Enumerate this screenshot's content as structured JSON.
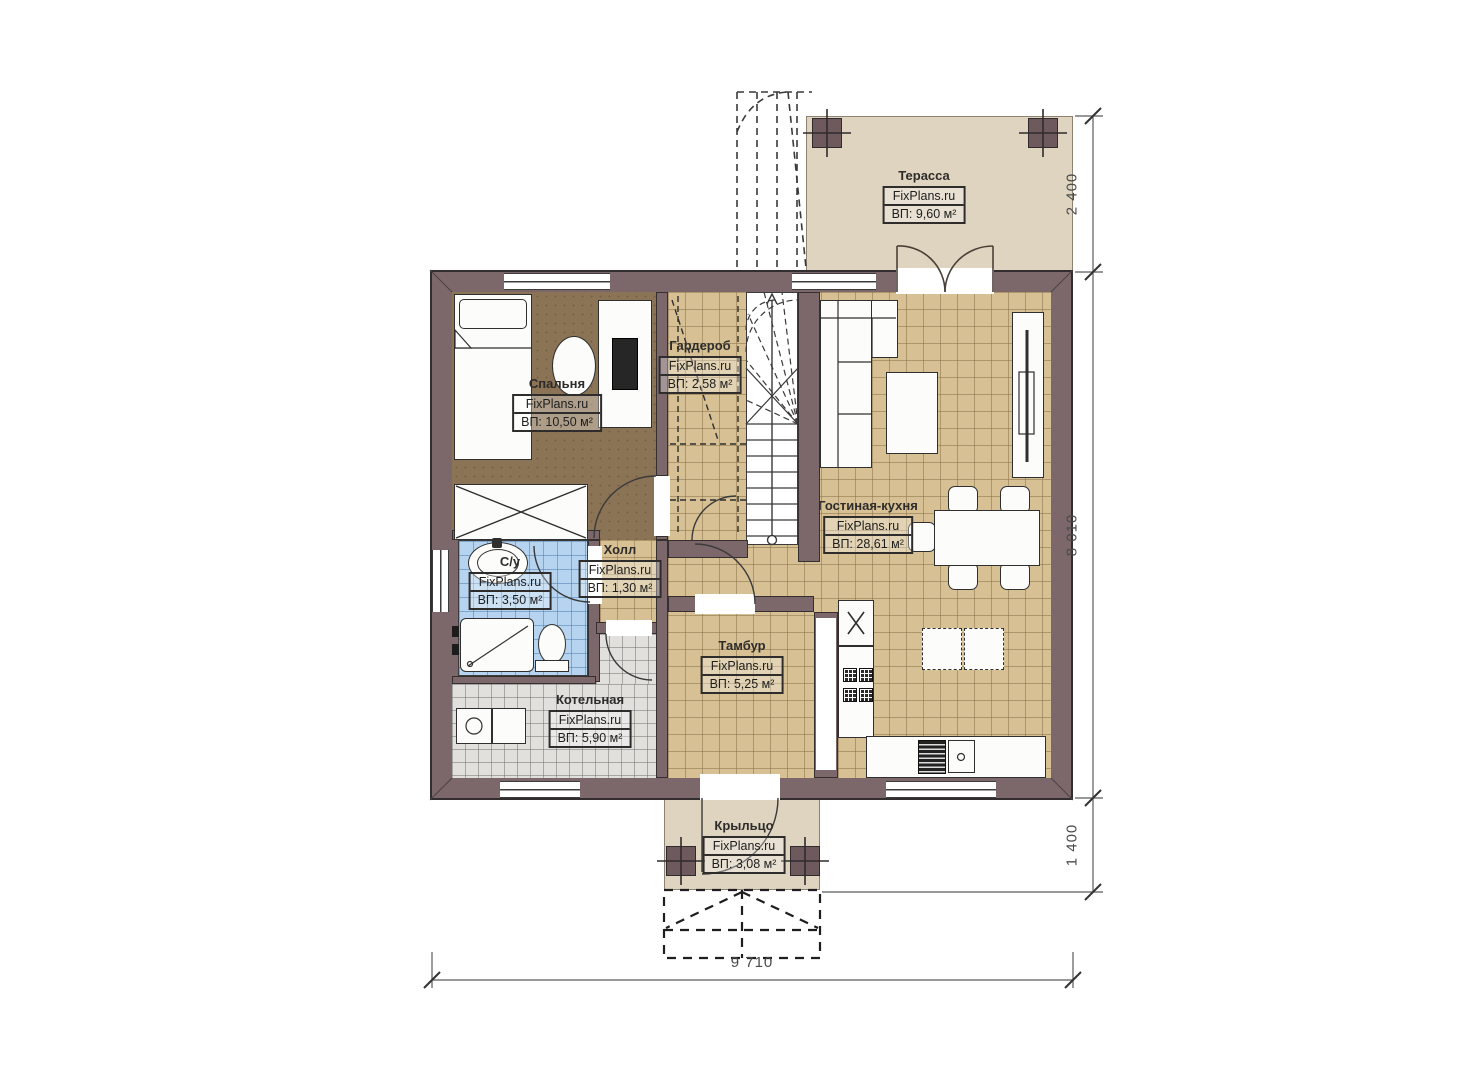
{
  "plan": {
    "brand": "FixPlans.ru",
    "rooms": [
      {
        "id": "terrace",
        "name": "Терасса",
        "brand": "FixPlans.ru",
        "area": "ВП: 9,60 м²"
      },
      {
        "id": "bedroom",
        "name": "Спальня",
        "brand": "FixPlans.ru",
        "area": "ВП: 10,50 м²"
      },
      {
        "id": "wardrobe",
        "name": "Гардероб",
        "brand": "FixPlans.ru",
        "area": "ВП: 2,58 м²"
      },
      {
        "id": "living-kitchen",
        "name": "Гостиная-кухня",
        "brand": "FixPlans.ru",
        "area": "ВП: 28,61 м²"
      },
      {
        "id": "hall",
        "name": "Холл",
        "brand": "FixPlans.ru",
        "area": "ВП: 1,30 м²"
      },
      {
        "id": "bathroom",
        "name": "С/у",
        "brand": "FixPlans.ru",
        "area": "ВП: 3,50 м²"
      },
      {
        "id": "vestibule",
        "name": "Тамбур",
        "brand": "FixPlans.ru",
        "area": "ВП: 5,25 м²"
      },
      {
        "id": "boiler-room",
        "name": "Котельная",
        "brand": "FixPlans.ru",
        "area": "ВП: 5,90 м²"
      },
      {
        "id": "porch",
        "name": "Крыльцо",
        "brand": "FixPlans.ru",
        "area": "ВП: 3,08 м²"
      }
    ],
    "dimensions": {
      "terrace_depth": "2 400",
      "house_depth": "8 010",
      "porch_depth": "1 400",
      "house_width": "9 710"
    },
    "palette": {
      "wall": "#7c686a",
      "floor_tile_tan": "#d6c094",
      "floor_tile_blue": "#b6d4ef",
      "floor_tile_gray": "#e1e0dd",
      "floor_carpet_brown": "#8b7355",
      "outdoor_beige": "#ded4c0"
    }
  }
}
